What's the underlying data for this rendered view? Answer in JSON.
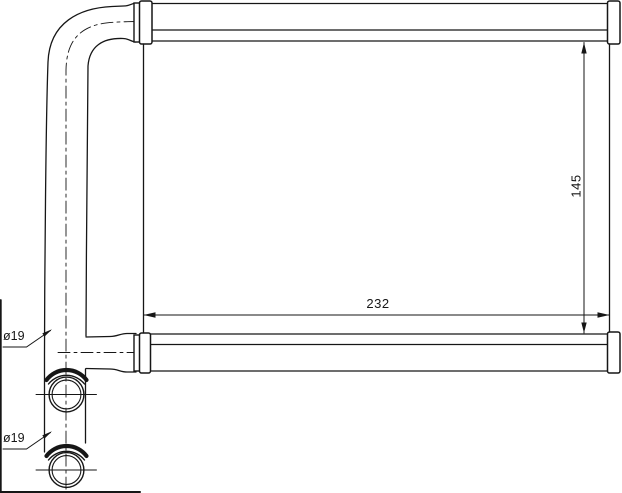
{
  "labels": {
    "width_dim": "232",
    "height_dim": "145",
    "upper_pipe_dia": "ø19",
    "lower_pipe_dia": "ø19"
  },
  "colors": {
    "line": "#161616",
    "background": "#ffffff"
  }
}
